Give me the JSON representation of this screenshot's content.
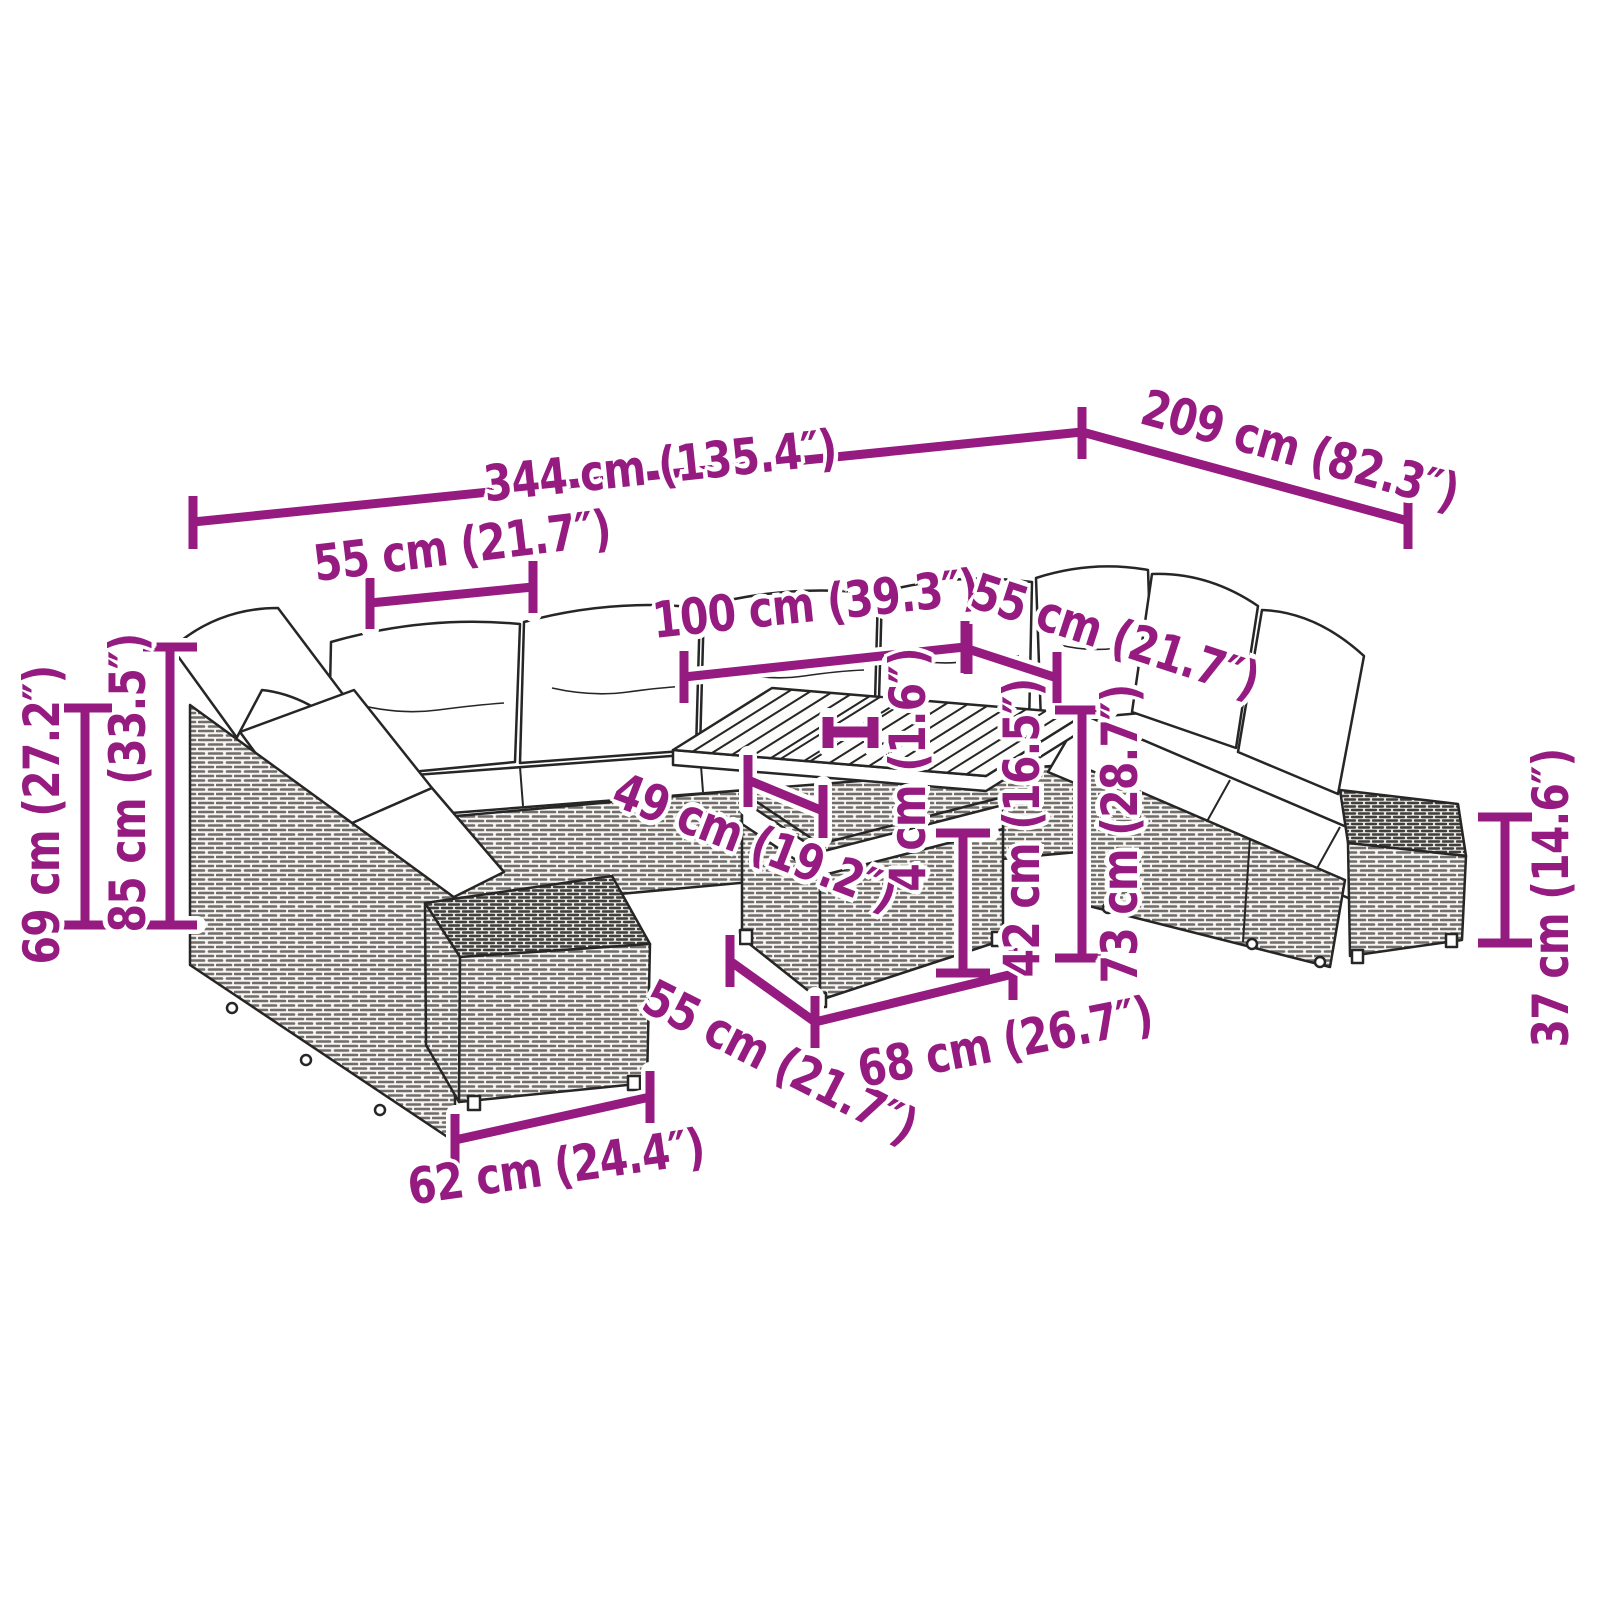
{
  "diagram": {
    "kind": "product dimension diagram",
    "product": "poly rattan garden lounge set with cushions, ottomans and slatted-top table",
    "units": [
      "cm",
      "inches"
    ],
    "accent_color": "#951B81",
    "line_art_color": "#262626",
    "background_color": "#ffffff"
  },
  "dims": [
    {
      "id": "overall-width",
      "text": "344 cm (135.4″)"
    },
    {
      "id": "overall-depth",
      "text": "209 cm (82.3″)"
    },
    {
      "id": "seat-module-width",
      "text": "55 cm (21.7″)"
    },
    {
      "id": "table-top-length",
      "text": "100 cm (39.3″)"
    },
    {
      "id": "seat-module-depth",
      "text": "55 cm (21.7″)"
    },
    {
      "id": "seat-clearance",
      "text": "49 cm (19.2″)"
    },
    {
      "id": "tabletop-thickness",
      "text": "4 cm (1.6″)"
    },
    {
      "id": "table-base-height",
      "text": "42 cm (16.5″)"
    },
    {
      "id": "table-height",
      "text": "73 cm (28.7″)"
    },
    {
      "id": "ottoman-height",
      "text": "37 cm (14.6″)"
    },
    {
      "id": "ottoman-width",
      "text": "62 cm (24.4″)"
    },
    {
      "id": "table-base-depth",
      "text": "55 cm (21.7″)"
    },
    {
      "id": "table-base-width",
      "text": "68 cm (26.7″)"
    },
    {
      "id": "backrest-height",
      "text": "69 cm (27.2″)"
    },
    {
      "id": "total-height",
      "text": "85 cm (33.5″)"
    }
  ]
}
